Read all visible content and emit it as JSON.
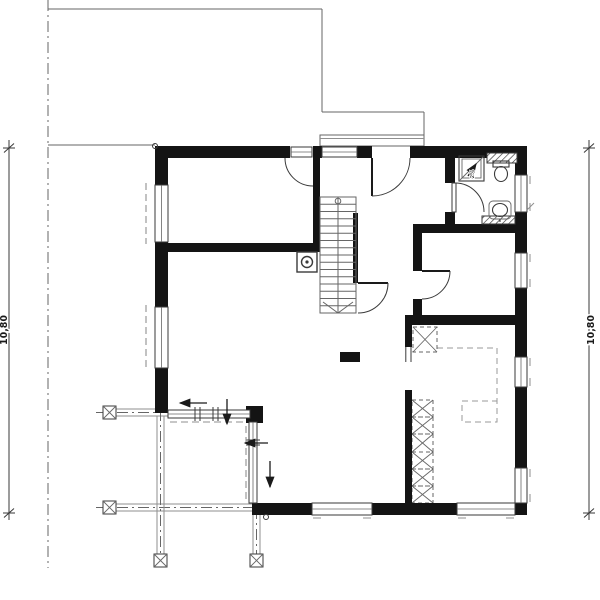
{
  "drawing": {
    "type": "architectural-floor-plan",
    "background": "#ffffff",
    "dimensions": {
      "left_label": "10,80",
      "right_label": "10,80"
    },
    "annotations": {
      "shower_slope_label": "2%"
    },
    "colors": {
      "wall": "#141414",
      "line": "#3a3a3a",
      "mid": "#666666",
      "light": "#8f8f8f",
      "dash": "#9a9a9a",
      "text": "#1a1a1a",
      "bg": "#ffffff"
    },
    "symbols": [
      "exterior-wall",
      "interior-wall",
      "window",
      "entrance-door",
      "interior-door",
      "staircase",
      "stair-direction-arrow",
      "chimney-flue",
      "shower",
      "toilet",
      "washbasin",
      "installation-wall-hatch",
      "terrace-glazing",
      "corner-column",
      "pergola-post",
      "pergola-beam",
      "entrance-canopy",
      "carport-outline",
      "wardrobe-dashed-boxes",
      "kitchen-dashed-outline",
      "slide-direction-arrow",
      "reference-point",
      "dimension-line"
    ]
  }
}
